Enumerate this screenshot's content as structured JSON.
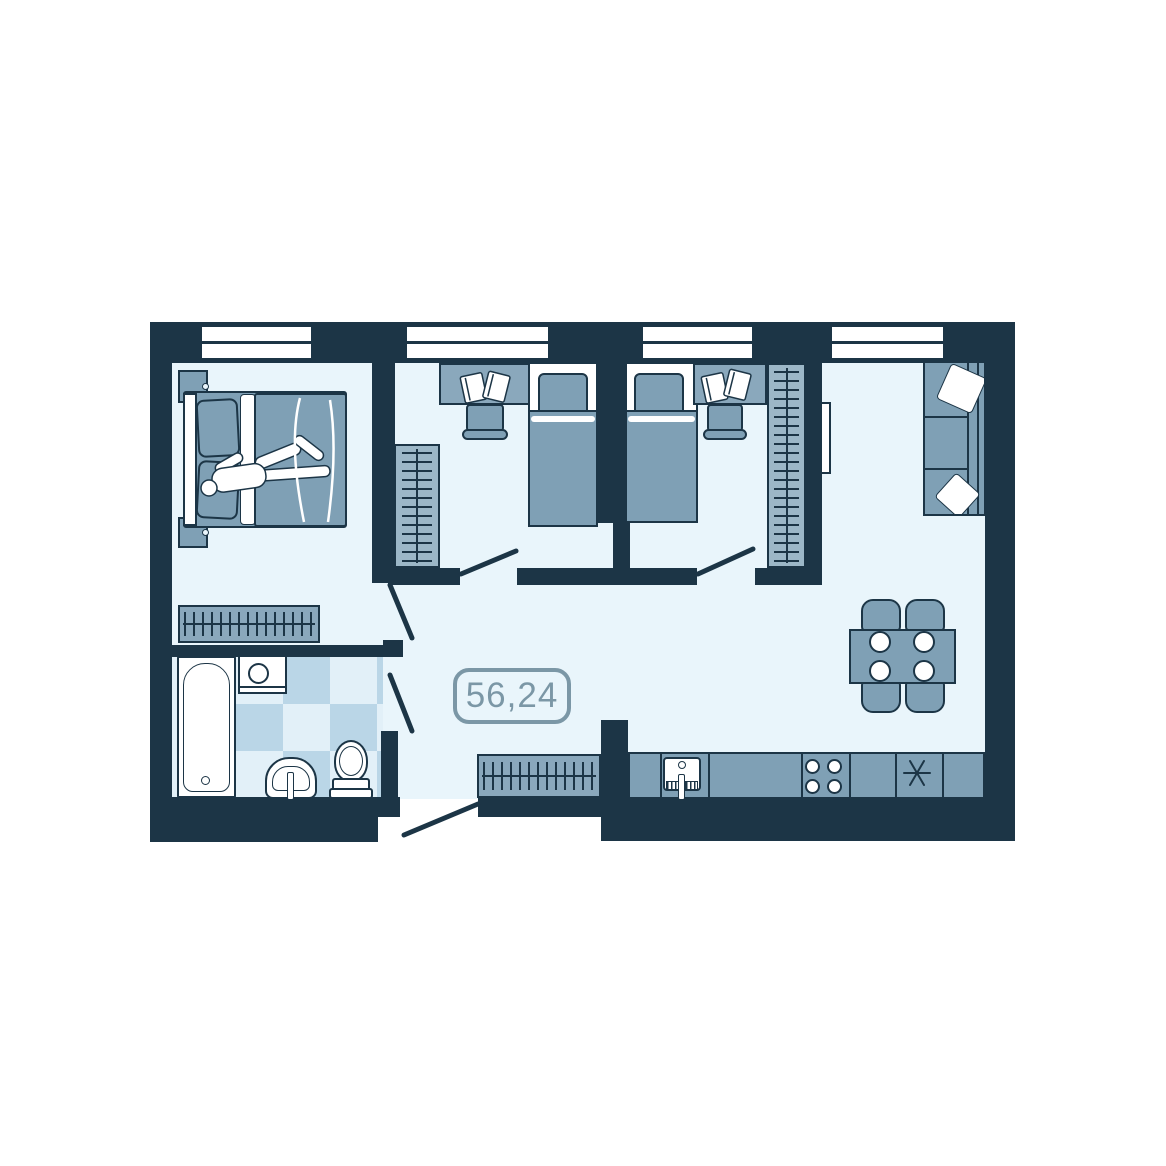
{
  "floor_plan": {
    "area_label": "56,24",
    "colors": {
      "wall": "#1c3546",
      "floor": "#e9f5fb",
      "furniture": "#7fa0b5",
      "furniture_light": "#9cb7c7",
      "cabinet": "#8aa8bc",
      "tile_light": "#e2f0f8",
      "tile_medium": "#bad6e7",
      "accent": "#7b97a6",
      "paper": "#ffffff"
    }
  }
}
